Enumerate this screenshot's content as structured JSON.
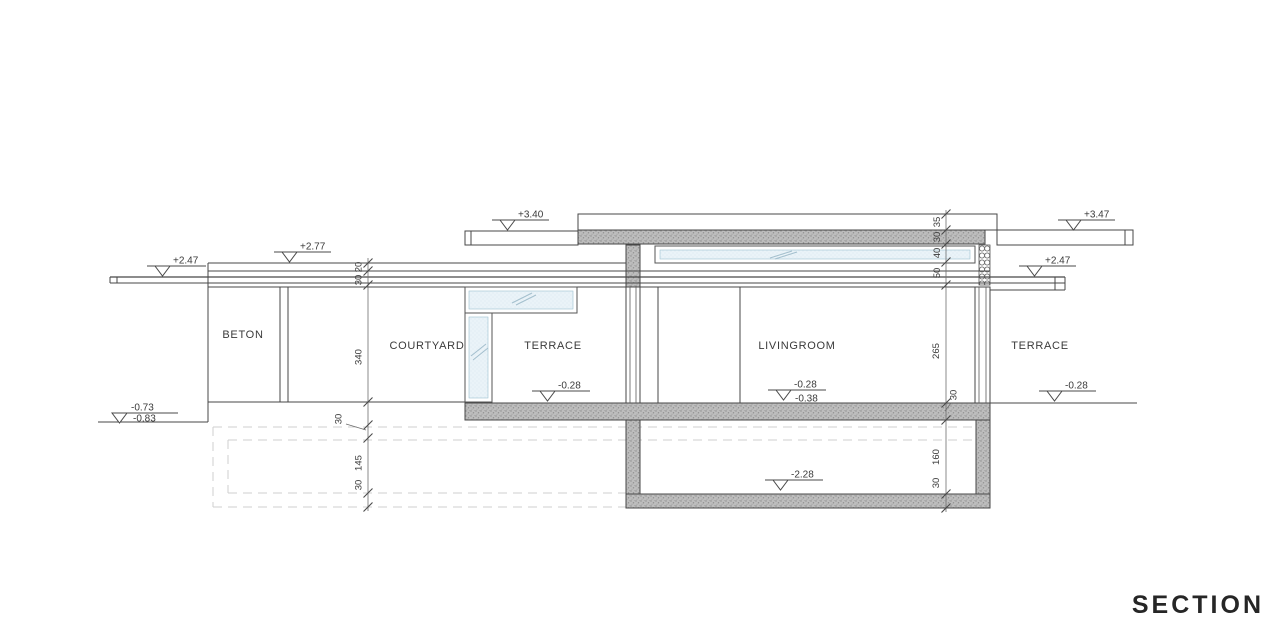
{
  "title": "SECTION",
  "rooms": {
    "beton": "BETON",
    "courtyard": "COURTYARD",
    "terrace_left": "TERRACE",
    "livingroom": "LIVINGROOM",
    "terrace_right": "TERRACE"
  },
  "elevations": {
    "canopy_left": "+2.47",
    "parapet_left": "+2.77",
    "roof_canopy_left": "+3.40",
    "roof_canopy_right": "+3.47",
    "canopy_right": "+2.47",
    "terrace_floor": "-0.28",
    "livingroom_floor_finish": "-0.28",
    "livingroom_floor_raw": "-0.38",
    "terrace_right_floor": "-0.28",
    "ground_left_upper": "-0.73",
    "ground_left_lower": "-0.83",
    "basement_floor": "-2.28"
  },
  "dimensions": {
    "parapet_cap_left": "20",
    "parapet_left_thickness": "30",
    "wall_height_left": "340",
    "slab_under_left": "30",
    "excavation_depth_left": "145",
    "excavation_slab_left": "30",
    "roof_parapet": "35",
    "roof_slab": "30",
    "clerestory_height": "40",
    "roof_beam": "50",
    "room_height": "265",
    "floor_slab_right": "30",
    "basement_height": "160",
    "basement_slab": "30"
  }
}
